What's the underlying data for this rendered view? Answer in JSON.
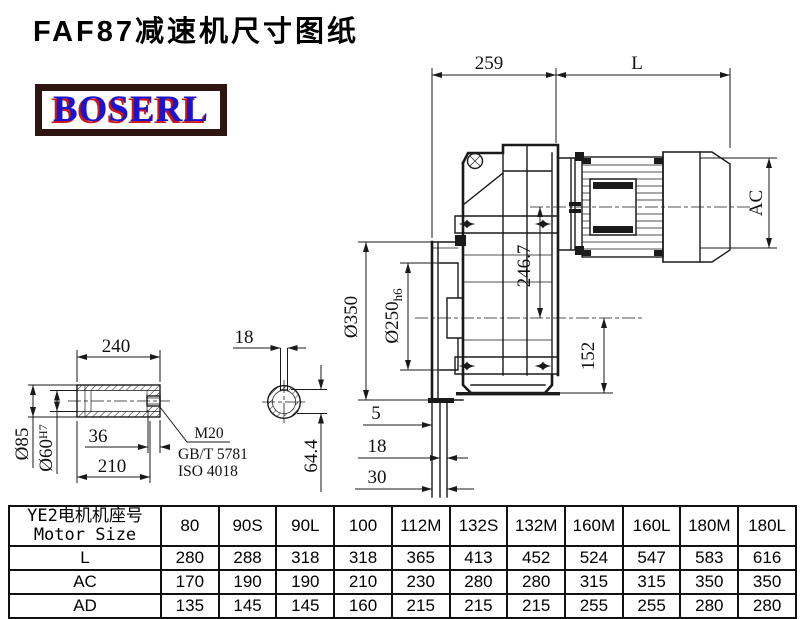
{
  "header": {
    "title": "FAF87减速机尺寸图纸",
    "brand": "BOSERL"
  },
  "colors": {
    "line": "#1a1a1a",
    "logo_border": "#2e150f",
    "logo_text": "#1a13cf",
    "logo_shadow": "#d01717",
    "table_border": "#111111"
  },
  "dims": {
    "main": {
      "gear_unit_length": "259",
      "motor_length": "L",
      "motor_diameter": "AC",
      "input_center_height": "246.7",
      "output_base_height": "152",
      "flange_diameter": "Ø350",
      "spigot_diameter": "Ø250",
      "spigot_tolerance": "h6",
      "face_offset_1": "5",
      "face_offset_2": "18",
      "face_offset_3": "30"
    },
    "shaft": {
      "hub_length": "240",
      "hub_outer_diameter": "Ø85",
      "bore_diameter": "Ø60",
      "bore_tolerance": "H7",
      "thread_depth": "36",
      "recess_length": "210",
      "thread_spec": "M20",
      "standard_gb": "GB/T 5781",
      "standard_iso": "ISO 4018",
      "key_width": "18",
      "key_section_height": "64.4"
    }
  },
  "table": {
    "header_zh": "YE2电机机座号",
    "header_en": "Motor Size",
    "columns": [
      "80",
      "90S",
      "90L",
      "100",
      "112M",
      "132S",
      "132M",
      "160M",
      "160L",
      "180M",
      "180L"
    ],
    "rows": [
      {
        "label": "L",
        "values": [
          "280",
          "288",
          "318",
          "318",
          "365",
          "413",
          "452",
          "524",
          "547",
          "583",
          "616"
        ]
      },
      {
        "label": "AC",
        "values": [
          "170",
          "190",
          "190",
          "210",
          "230",
          "280",
          "280",
          "315",
          "315",
          "350",
          "350"
        ]
      },
      {
        "label": "AD",
        "values": [
          "135",
          "145",
          "145",
          "160",
          "215",
          "215",
          "215",
          "255",
          "255",
          "280",
          "280"
        ]
      }
    ]
  }
}
